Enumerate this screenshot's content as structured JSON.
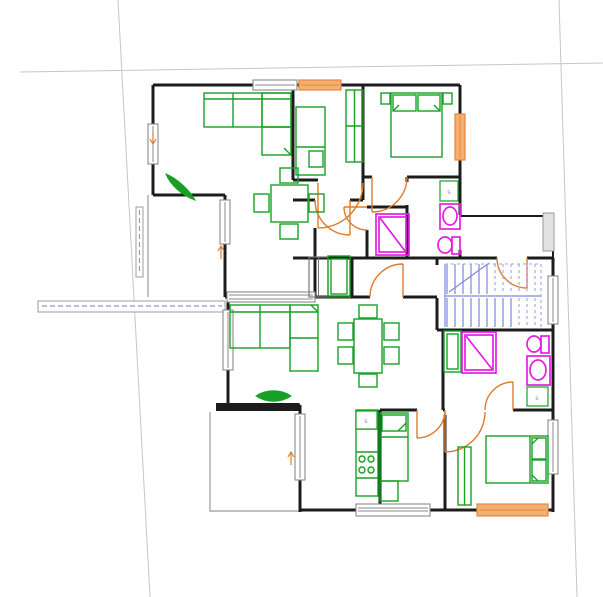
{
  "drawing": {
    "type": "architectural-floor-plan",
    "units_shown": 2,
    "stairwell": {
      "flights": 2,
      "lower_flight_style": "solid",
      "upper_flight_style": "dashed"
    }
  },
  "colors": {
    "background": "#ffffff",
    "wall": "#1c1c1c",
    "window": "#8a8a8a",
    "window_orange": "#e8873c",
    "window_orange_fill": "#f3b071",
    "door": "#e07b28",
    "furniture": "#16a125",
    "fixture": "#e21fe2",
    "stairs": "#7d89dd",
    "stairs_dashed": "#9aa4e8",
    "guide_dashed": "#8f9ae0",
    "site_line": "#c6c6c6",
    "terrace": "#9b9b9b",
    "s_label": "#8794cc"
  },
  "markers": {
    "s_boxes": [
      {
        "label": "s"
      },
      {
        "label": "s"
      },
      {
        "label": "s"
      }
    ],
    "arrows": [
      {
        "icon": "arrow-down-icon"
      },
      {
        "icon": "arrow-up-icon"
      },
      {
        "icon": "arrow-up-icon"
      }
    ]
  }
}
